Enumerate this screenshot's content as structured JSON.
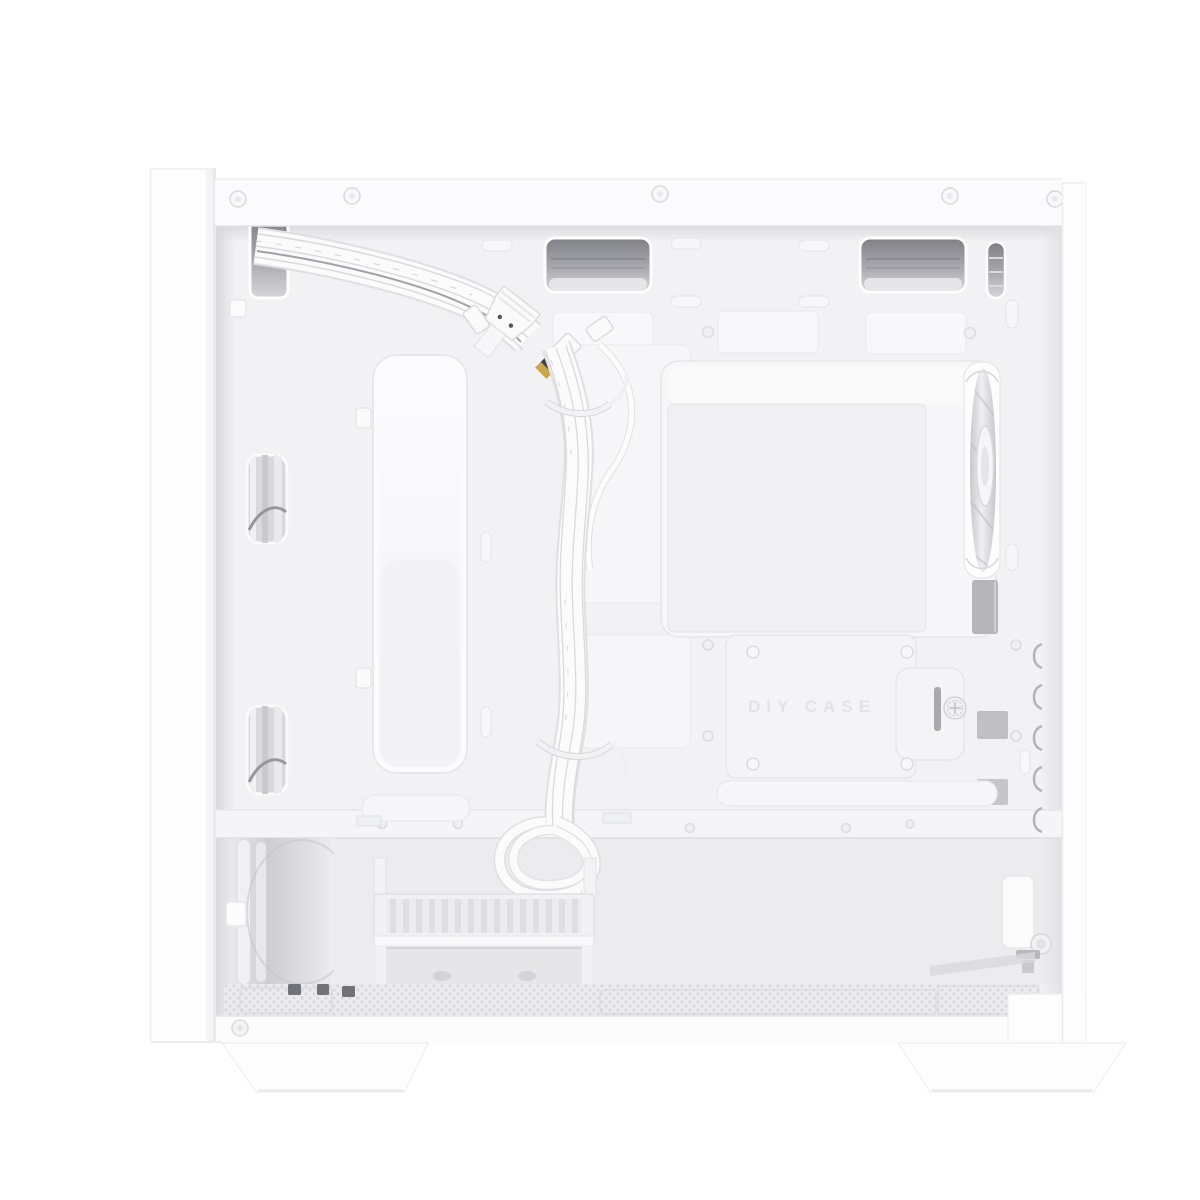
{
  "photo": {
    "subject": "White mini-tower PC case photographed with side panel removed, interior view",
    "orientation": "front panel at left, rear exhaust fan at right, PSU bay at bottom"
  },
  "palette": {
    "background": "#ffffff",
    "case_white": "#fcfcfd",
    "panel_seam": "#e8e8eb",
    "interior_wall": "#f2f2f4",
    "recess_dark": "#84848b",
    "mesh_dot": "#d7d7db",
    "cable_white": "#fafafb",
    "metal_gray": "#b5b5ba",
    "gold_contact": "#caa64e"
  },
  "tray_label": {
    "text": "DIY CASE"
  },
  "parts": {
    "front_panel": "front panel",
    "top_rail": "top frame rail with rivets",
    "cable_grommets": "top cable pass-through cutouts",
    "radiator_cutout": "tall front cutout",
    "mobo_opening": "motherboard tray opening",
    "rear_fan": "rear exhaust fan",
    "front_cables": "front panel cable bundle",
    "usb_connector": "USB 3.0 header connector",
    "audio_connector": "HD audio connector",
    "drive_tray": "drive tray bracket with thumbscrew",
    "hdd_cage": "drive cage with vented tray",
    "psu_bay": "power supply bay",
    "mesh_floor": "ventilated bottom panel",
    "case_feet": "case feet"
  }
}
